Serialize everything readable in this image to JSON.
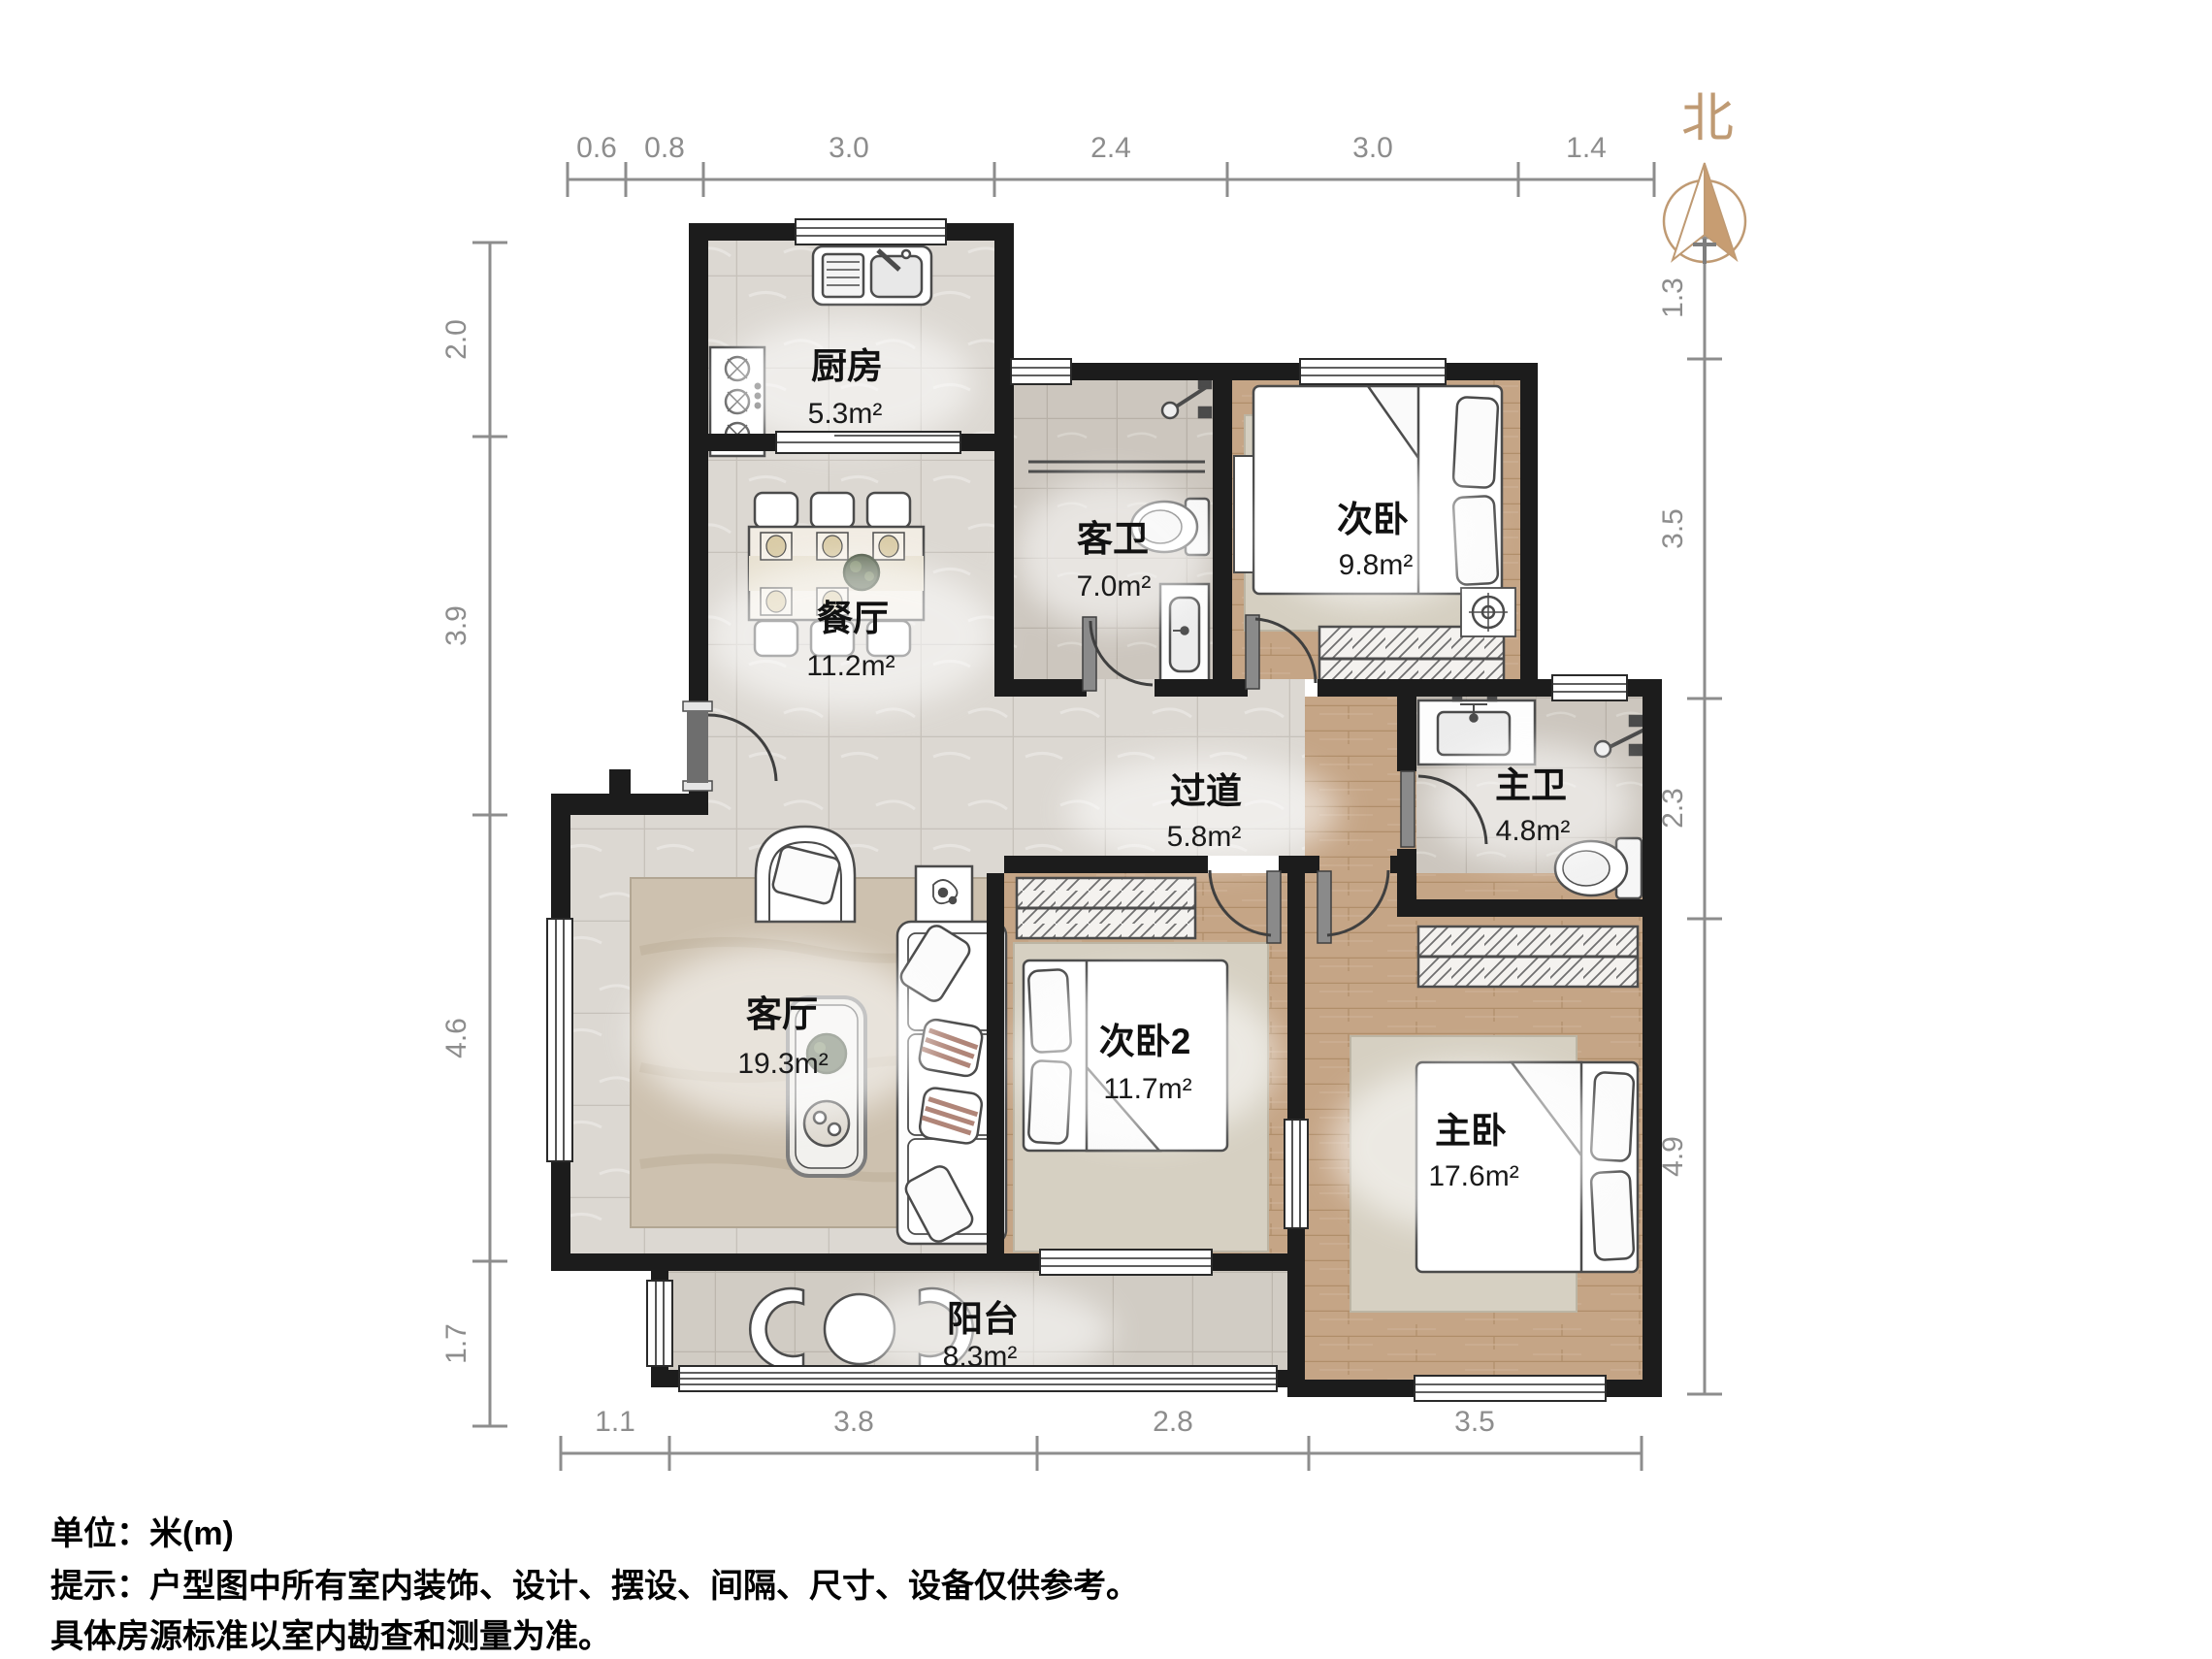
{
  "meta": {
    "unit_label": "单位：米(m)",
    "note_line1": "提示：户型图中所有室内装饰、设计、摆设、间隔、尺寸、设备仅供参考。",
    "note_line2": "具体房源标准以室内勘查和测量为准。",
    "north_label": "北"
  },
  "rooms": [
    {
      "id": "kitchen",
      "name": "厨房",
      "area": "5.3m²"
    },
    {
      "id": "dining",
      "name": "餐厅",
      "area": "11.2m²"
    },
    {
      "id": "guest-bath",
      "name": "客卫",
      "area": "7.0m²"
    },
    {
      "id": "bedroom2",
      "name": "次卧",
      "area": "9.8m²"
    },
    {
      "id": "hallway",
      "name": "过道",
      "area": "5.8m²"
    },
    {
      "id": "master-bath",
      "name": "主卫",
      "area": "4.8m²"
    },
    {
      "id": "living",
      "name": "客厅",
      "area": "19.3m²"
    },
    {
      "id": "bedroom3",
      "name": "次卧2",
      "area": "11.7m²"
    },
    {
      "id": "master-bed",
      "name": "主卧",
      "area": "17.6m²"
    },
    {
      "id": "balcony",
      "name": "阳台",
      "area": "8.3m²"
    }
  ],
  "dimensions": {
    "top": [
      "0.6",
      "0.8",
      "3.0",
      "2.4",
      "3.0",
      "1.4"
    ],
    "left": [
      "2.0",
      "3.9",
      "4.6",
      "1.7"
    ],
    "right": [
      "1.3",
      "3.5",
      "2.3",
      "4.9"
    ],
    "bottom": [
      "1.1",
      "3.8",
      "2.8",
      "3.5"
    ]
  },
  "colors": {
    "wall": "#1c1c1c",
    "dimension": "#8d8d8d",
    "north_accent": "#bf9a73",
    "label": "#111111"
  }
}
